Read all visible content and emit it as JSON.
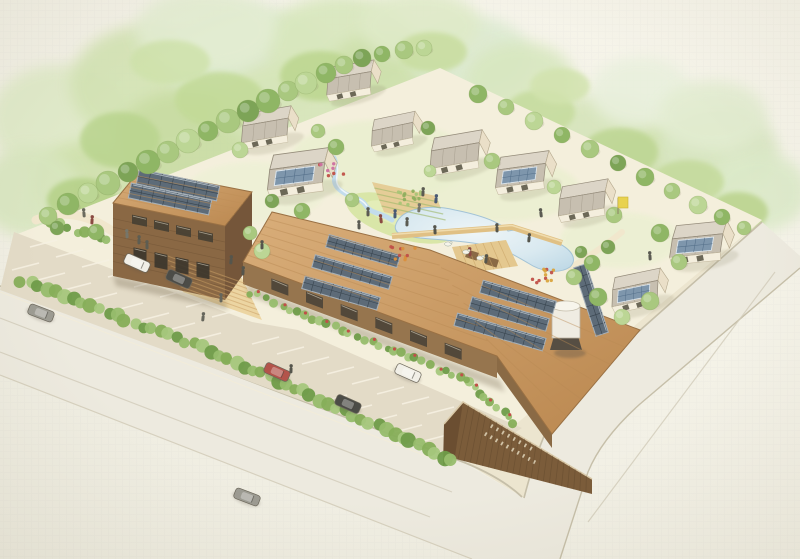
{
  "scene": {
    "type": "watercolor-aerial-site-rendering",
    "subject": "eco-village with solar buildings, houses, pond, parking and roads",
    "building_sign": {
      "legible": false,
      "rows": [
        8,
        10
      ]
    }
  },
  "palette": {
    "paperA": "#f7f5eb",
    "paperB": "#eeece0",
    "site": "#f4efdc",
    "asphalt": "#e3dbc7",
    "road": "#edeadf",
    "curb": "#c6bfa9",
    "stall": "#f6f1e2",
    "lane": "#d2ccba",
    "roofTanA": "#d9ae7a",
    "roofTanB": "#ba874f",
    "woodWall": "#96754e",
    "woodDark": "#7b5c3a",
    "woodDarker": "#6b4e31",
    "solarDark": "#5d6b78",
    "solarFrame": "#a7b1b9",
    "solarHouse": "#7e96ac",
    "pondEdge": "#a3c3d6",
    "lawn": "#d9e6a8",
    "path": "#f1e7cd",
    "deckWood": "#e4c88f",
    "stepWood": "#ecd5a2",
    "gardenSoil": "#e5cd97",
    "houseWall": "#f4eedd",
    "houseRoofFront": "#c7bfb0",
    "houseRoofBack": "#dcd5c7",
    "tankWhite": "#efece2"
  },
  "treeColors": [
    "#a9c87f",
    "#8fb665",
    "#bcd695",
    "#7da457"
  ],
  "forest": [
    [
      60,
      120,
      70,
      55,
      "#dfeac8"
    ],
    [
      150,
      85,
      80,
      60,
      "#d3e3b4"
    ],
    [
      250,
      62,
      85,
      55,
      "#dbe9cc"
    ],
    [
      340,
      46,
      75,
      50,
      "#d8e7bd"
    ],
    [
      95,
      185,
      65,
      45,
      "#cfe0ac"
    ],
    [
      190,
      140,
      75,
      50,
      "#c8dca2"
    ],
    [
      290,
      106,
      70,
      45,
      "#d6e5b8"
    ],
    [
      390,
      76,
      65,
      45,
      "#cde0ab"
    ],
    [
      470,
      56,
      60,
      40,
      "#dcead0"
    ],
    [
      205,
      30,
      70,
      40,
      "#e3edd2"
    ],
    [
      420,
      26,
      60,
      35,
      "#dfeac8"
    ],
    [
      520,
      82,
      55,
      40,
      "#d8e7c0"
    ],
    [
      600,
      140,
      70,
      45,
      "#d5e4ba"
    ],
    [
      660,
      172,
      65,
      45,
      "#cfe0ae"
    ],
    [
      718,
      152,
      60,
      45,
      "#d8e6c2"
    ],
    [
      758,
      192,
      50,
      40,
      "#dceac9"
    ],
    [
      640,
      92,
      50,
      35,
      "#e9f0dd"
    ],
    [
      712,
      116,
      55,
      35,
      "#e2ecd0"
    ],
    [
      30,
      192,
      50,
      45,
      "#d8e6bf"
    ]
  ],
  "midTrees": [
    [
      120,
      140,
      40,
      28,
      "#b9d48e"
    ],
    [
      220,
      100,
      45,
      28,
      "#c2da97"
    ],
    [
      320,
      76,
      40,
      25,
      "#bcd68f"
    ],
    [
      82,
      200,
      35,
      22,
      "#b4d086"
    ],
    [
      540,
      112,
      35,
      22,
      "#c6dc9e"
    ],
    [
      620,
      152,
      38,
      24,
      "#bdd693"
    ],
    [
      688,
      182,
      36,
      22,
      "#c4da9b"
    ],
    [
      738,
      212,
      30,
      20,
      "#bad38c"
    ],
    [
      170,
      62,
      40,
      22,
      "#cfe2ab"
    ],
    [
      432,
      52,
      35,
      20,
      "#c8dd9f"
    ],
    [
      560,
      86,
      30,
      18,
      "#d2e3ae"
    ]
  ],
  "washes": [
    [
      380,
      160,
      90,
      40,
      "#e8efcd"
    ],
    [
      255,
      192,
      70,
      30,
      "#ecf1d4"
    ],
    [
      500,
      190,
      80,
      32,
      "#e9efce"
    ],
    [
      620,
      240,
      60,
      28,
      "#eaf0d0"
    ]
  ],
  "siteTrees": [
    [
      48,
      216,
      9,
      0
    ],
    [
      68,
      204,
      11,
      1
    ],
    [
      88,
      193,
      10,
      2
    ],
    [
      108,
      183,
      12,
      0
    ],
    [
      128,
      172,
      10,
      3
    ],
    [
      148,
      162,
      12,
      1
    ],
    [
      168,
      152,
      11,
      0
    ],
    [
      188,
      141,
      12,
      2
    ],
    [
      208,
      131,
      10,
      1
    ],
    [
      228,
      121,
      12,
      0
    ],
    [
      248,
      111,
      11,
      3
    ],
    [
      268,
      101,
      12,
      1
    ],
    [
      288,
      91,
      10,
      0
    ],
    [
      306,
      83,
      11,
      2
    ],
    [
      326,
      73,
      10,
      1
    ],
    [
      344,
      65,
      9,
      0
    ],
    [
      362,
      58,
      9,
      3
    ],
    [
      382,
      54,
      8,
      1
    ],
    [
      404,
      50,
      9,
      0
    ],
    [
      424,
      48,
      8,
      2
    ],
    [
      478,
      94,
      9,
      1
    ],
    [
      506,
      107,
      8,
      0
    ],
    [
      534,
      121,
      9,
      2
    ],
    [
      562,
      135,
      8,
      1
    ],
    [
      590,
      149,
      9,
      0
    ],
    [
      618,
      163,
      8,
      3
    ],
    [
      645,
      177,
      9,
      1
    ],
    [
      672,
      191,
      8,
      0
    ],
    [
      698,
      205,
      9,
      2
    ],
    [
      722,
      217,
      8,
      1
    ],
    [
      744,
      228,
      7,
      0
    ],
    [
      240,
      150,
      8,
      2
    ],
    [
      318,
      131,
      7,
      0
    ],
    [
      336,
      147,
      8,
      1
    ],
    [
      428,
      128,
      7,
      3
    ],
    [
      492,
      161,
      8,
      0
    ],
    [
      554,
      187,
      7,
      2
    ],
    [
      614,
      215,
      8,
      0
    ],
    [
      660,
      233,
      9,
      1
    ],
    [
      679,
      262,
      8,
      0
    ],
    [
      608,
      247,
      7,
      3
    ],
    [
      592,
      263,
      8,
      1
    ],
    [
      352,
      200,
      7,
      0
    ],
    [
      430,
      171,
      6,
      2
    ],
    [
      302,
      211,
      8,
      1
    ],
    [
      272,
      201,
      7,
      3
    ],
    [
      574,
      277,
      8,
      0
    ],
    [
      598,
      297,
      9,
      1
    ],
    [
      622,
      317,
      8,
      2
    ],
    [
      650,
      301,
      9,
      0
    ],
    [
      581,
      252,
      6,
      3
    ],
    [
      96,
      232,
      8,
      1
    ],
    [
      250,
      233,
      7,
      0
    ],
    [
      262,
      251,
      8,
      2
    ],
    [
      57,
      228,
      7,
      3
    ]
  ],
  "hedges": [
    {
      "a": [
        22,
        280
      ],
      "b": [
        228,
        358
      ],
      "step": 9,
      "r": 6.5,
      "flowers": false
    },
    {
      "a": [
        228,
        358
      ],
      "b": [
        452,
        460
      ],
      "step": 9,
      "r": 6.5,
      "flowers": false
    },
    {
      "a": [
        252,
        293
      ],
      "b": [
        468,
        381
      ],
      "step": 8,
      "r": 4,
      "flowers": true
    },
    {
      "a": [
        52,
        222
      ],
      "b": [
        108,
        242
      ],
      "step": 8,
      "r": 5,
      "flowers": false
    },
    {
      "a": [
        468,
        381
      ],
      "b": [
        515,
        424
      ],
      "step": 8,
      "r": 4,
      "flowers": true
    }
  ],
  "flowerPatches": [
    {
      "x": 404,
      "y": 253,
      "n": 10,
      "colors": [
        "#c05048",
        "#d98f3e"
      ]
    },
    {
      "x": 545,
      "y": 276,
      "n": 12,
      "colors": [
        "#c05048",
        "#d9a43e"
      ]
    },
    {
      "x": 332,
      "y": 170,
      "n": 8,
      "colors": [
        "#c05048",
        "#cc6fa0"
      ]
    },
    {
      "x": 410,
      "y": 198,
      "n": 14,
      "colors": [
        "#8fae5e",
        "#a8c476"
      ]
    }
  ],
  "parkingRows": [
    {
      "x": 30,
      "y": 247,
      "n": 8,
      "step": [
        26,
        10
      ],
      "line": [
        27,
        -7
      ]
    },
    {
      "x": 12,
      "y": 270,
      "n": 8,
      "step": [
        26,
        10
      ],
      "line": [
        27,
        -7
      ]
    },
    {
      "x": 252,
      "y": 344,
      "n": 9,
      "step": [
        25,
        10
      ],
      "line": [
        27,
        -7
      ]
    },
    {
      "x": 320,
      "y": 402,
      "n": 7,
      "step": [
        25,
        10
      ],
      "line": [
        27,
        -7
      ]
    }
  ],
  "laneLines": [
    [
      0,
      318,
      452,
      492
    ],
    [
      0,
      352,
      430,
      517
    ],
    [
      588,
      522,
      775,
      272
    ]
  ],
  "plankSets": [
    {
      "a": [
        243,
        262
      ],
      "b": [
        272,
        212
      ],
      "d": [
        497,
        356
      ],
      "c": [
        430,
        250
      ],
      "n": 6,
      "color": "#b98a54",
      "w": 1,
      "o": 0.45
    },
    {
      "a": [
        497,
        356
      ],
      "b": [
        430,
        250
      ],
      "d": [
        552,
        434
      ],
      "c": [
        640,
        330
      ],
      "n": 5,
      "color": "#b98a54",
      "w": 1,
      "o": 0.45
    },
    {
      "a": [
        113,
        203
      ],
      "b": [
        140,
        170
      ],
      "d": [
        225,
        226
      ],
      "c": [
        252,
        192
      ],
      "n": 5,
      "color": "#bf8f58",
      "w": 1,
      "o": 0.5
    },
    {
      "a": [
        463,
        402
      ],
      "b": [
        592,
        479
      ],
      "d": [
        452,
        458
      ],
      "c": [
        592,
        494
      ],
      "n": 22,
      "color": "#5f462c",
      "w": 0.8,
      "o": 0.45
    },
    {
      "a": [
        452,
        247
      ],
      "b": [
        506,
        240
      ],
      "d": [
        462,
        274
      ],
      "c": [
        518,
        266
      ],
      "n": 6,
      "color": "#c8a264",
      "w": 0.8,
      "o": 0.6
    },
    {
      "a": [
        113,
        210
      ],
      "b": [
        113,
        270
      ],
      "d": [
        225,
        233
      ],
      "c": [
        225,
        296
      ],
      "n": 6,
      "color": "#6e5134",
      "w": 0.7,
      "o": 0.5
    },
    {
      "a": [
        163,
        250
      ],
      "b": [
        183,
        292
      ],
      "d": [
        242,
        278
      ],
      "c": [
        262,
        320
      ],
      "n": 7,
      "color": "#caa066",
      "w": 1,
      "o": 0.55
    },
    {
      "a": [
        372,
        182
      ],
      "b": [
        384,
        212
      ],
      "d": [
        436,
        196
      ],
      "c": [
        448,
        226
      ],
      "n": 4,
      "color": "#9fb86a",
      "w": 1.2,
      "o": 0.6
    }
  ],
  "windowSets": [
    {
      "a": [
        254,
        272
      ],
      "b": [
        462,
        349
      ],
      "n": 6,
      "w": 17,
      "h": 11,
      "slope": 0.373,
      "fill": "#4a4438"
    },
    {
      "a": [
        121,
        212
      ],
      "b": [
        209,
        233
      ],
      "n": 4,
      "w": 15,
      "h": 9,
      "slope": 0.21,
      "fill": "#453f33"
    },
    {
      "a": [
        123,
        245
      ],
      "b": [
        207,
        264
      ],
      "n": 4,
      "w": 13,
      "h": 15,
      "slope": 0.21,
      "fill": "#3a352c"
    }
  ],
  "solarArrays": [
    {
      "x": 363,
      "y": 251,
      "len": 74,
      "h": 13,
      "rot": 16,
      "cols": 8
    },
    {
      "x": 352,
      "y": 272,
      "len": 80,
      "h": 13,
      "rot": 16,
      "cols": 8
    },
    {
      "x": 341,
      "y": 293,
      "len": 78,
      "h": 13,
      "rot": 16,
      "cols": 8
    },
    {
      "x": 518,
      "y": 297,
      "len": 76,
      "h": 13,
      "rot": 16,
      "cols": 8
    },
    {
      "x": 509,
      "y": 314,
      "len": 80,
      "h": 13,
      "rot": 16,
      "cols": 8
    },
    {
      "x": 500,
      "y": 332,
      "len": 92,
      "h": 13,
      "rot": 16,
      "cols": 9
    },
    {
      "x": 591,
      "y": 300,
      "len": 72,
      "h": 13,
      "rot": 72,
      "cols": 7
    },
    {
      "x": 178,
      "y": 185,
      "len": 82,
      "h": 15,
      "rot": 12,
      "cols": 7
    },
    {
      "x": 170,
      "y": 199,
      "len": 82,
      "h": 15,
      "rot": 12,
      "cols": 7
    }
  ],
  "houses": [
    {
      "x": 268,
      "y": 127,
      "s": 1.0,
      "rot": -16,
      "solar": false
    },
    {
      "x": 352,
      "y": 80,
      "s": 0.95,
      "rot": -16,
      "solar": false
    },
    {
      "x": 300,
      "y": 172,
      "s": 1.2,
      "rot": -14,
      "solar": true
    },
    {
      "x": 395,
      "y": 131,
      "s": 0.9,
      "rot": -18,
      "solar": false
    },
    {
      "x": 458,
      "y": 152,
      "s": 1.05,
      "rot": -16,
      "solar": false
    },
    {
      "x": 524,
      "y": 172,
      "s": 1.05,
      "rot": -14,
      "solar": true
    },
    {
      "x": 585,
      "y": 200,
      "s": 1.0,
      "rot": -16,
      "solar": false
    },
    {
      "x": 700,
      "y": 242,
      "s": 1.1,
      "rot": -12,
      "solar": true
    },
    {
      "x": 638,
      "y": 290,
      "s": 1.0,
      "rot": -18,
      "solar": true
    }
  ],
  "carColors": {
    "white": "#f1efe7",
    "red": "#b3544b",
    "dark": "#4c4c47",
    "gray": "#9c9b92"
  },
  "cars": [
    {
      "x": 137,
      "y": 263,
      "rot": 24,
      "c": "white"
    },
    {
      "x": 179,
      "y": 279,
      "rot": 24,
      "c": "dark"
    },
    {
      "x": 277,
      "y": 372,
      "rot": 24,
      "c": "red"
    },
    {
      "x": 348,
      "y": 404,
      "rot": 24,
      "c": "dark"
    },
    {
      "x": 408,
      "y": 373,
      "rot": 24,
      "c": "white"
    },
    {
      "x": 41,
      "y": 313,
      "rot": 21,
      "c": "gray"
    },
    {
      "x": 247,
      "y": 497,
      "rot": 21,
      "c": "gray"
    }
  ],
  "people": [
    [
      84,
      214,
      "#6b6b5e"
    ],
    [
      92,
      221,
      "#8a4a42"
    ],
    [
      139,
      241,
      "#5d5d52"
    ],
    [
      147,
      246,
      "#5d5d52"
    ],
    [
      127,
      235,
      "#76766a"
    ],
    [
      231,
      261,
      "#55554c"
    ],
    [
      243,
      272,
      "#55554c"
    ],
    [
      221,
      299,
      "#66665c"
    ],
    [
      262,
      246,
      "#55554c"
    ],
    [
      368,
      213,
      "#5b5b52"
    ],
    [
      381,
      220,
      "#8a4a42"
    ],
    [
      395,
      215,
      "#4a5a74"
    ],
    [
      407,
      223,
      "#5b5b52"
    ],
    [
      359,
      226,
      "#5b5b52"
    ],
    [
      419,
      209,
      "#76766a"
    ],
    [
      435,
      231,
      "#55554c"
    ],
    [
      497,
      229,
      "#55554c"
    ],
    [
      470,
      253,
      "#8a4a42"
    ],
    [
      486,
      260,
      "#55554c"
    ],
    [
      423,
      193,
      "#5b5b52"
    ],
    [
      436,
      200,
      "#4a5a74"
    ],
    [
      529,
      239,
      "#55554c"
    ],
    [
      541,
      214,
      "#5b5b52"
    ],
    [
      291,
      370,
      "#55554c"
    ],
    [
      203,
      318,
      "#66665c"
    ],
    [
      650,
      257,
      "#5b5b52"
    ]
  ],
  "ducks": [
    [
      466,
      252
    ],
    [
      480,
      258
    ],
    [
      448,
      244
    ]
  ],
  "signMarks": {
    "rows": [
      {
        "x": 492,
        "y": 424,
        "n": 8,
        "dx": 5.6,
        "dy": 3.2
      },
      {
        "x": 486,
        "y": 432,
        "n": 10,
        "dx": 5.4,
        "dy": 3.1
      }
    ]
  }
}
